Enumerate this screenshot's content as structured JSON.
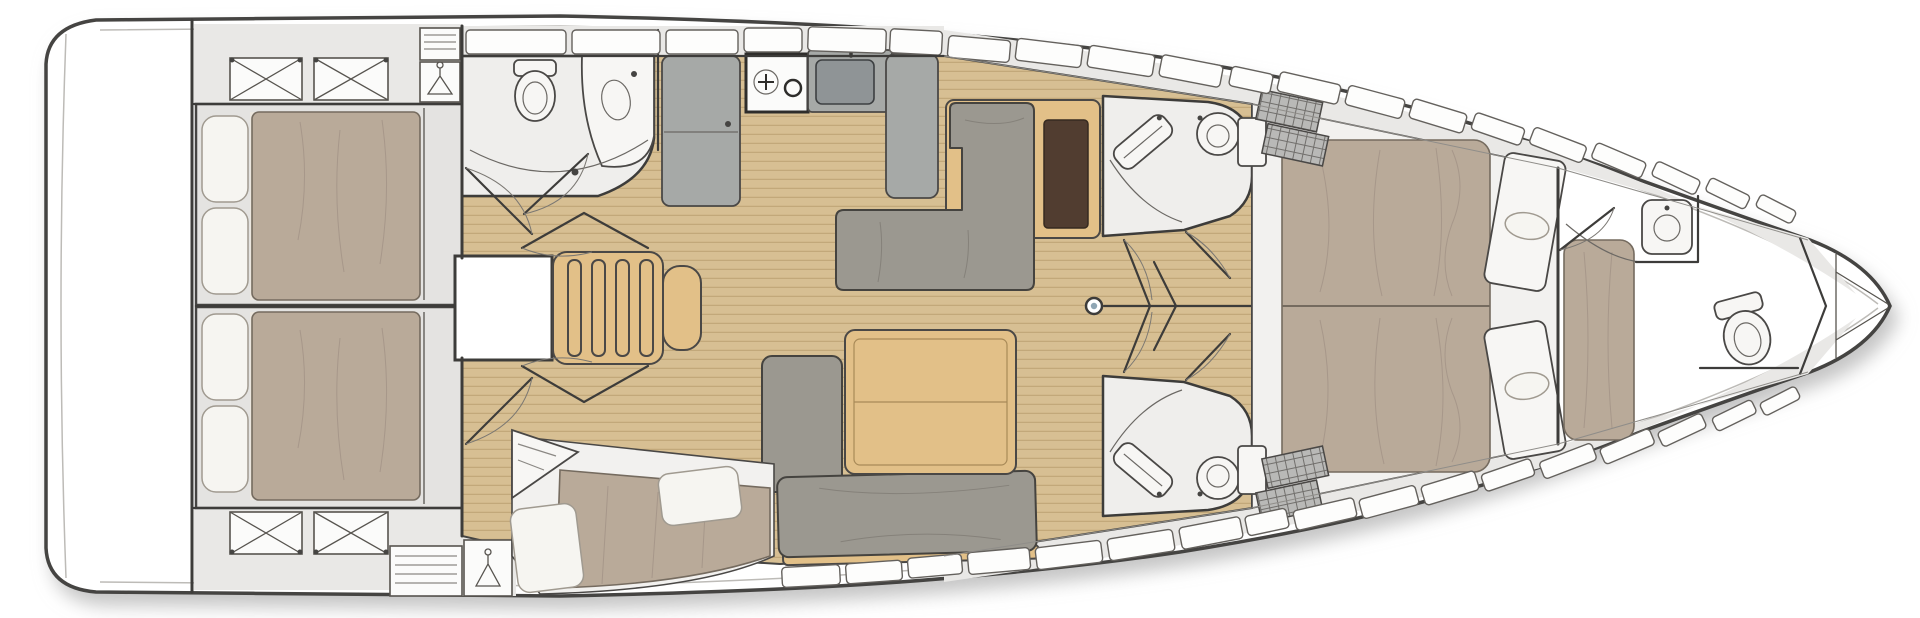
{
  "meta": {
    "title": "Sailing yacht interior layout — overhead deck plan",
    "view": "top-down floor plan",
    "orientation": "bow-right",
    "visible_text": "none"
  },
  "palette": {
    "background": "#ffffff",
    "hull_outline": "#454442",
    "side_deck": "#e9e8e6",
    "wood_floor": "#d7bf93",
    "wood_floor_line": "#c2a87a",
    "furniture_wood": "#e2c088",
    "upholstery_gray": "#9b9890",
    "mattress_taupe": "#b9aa99",
    "pillow_white": "#f6f5f1",
    "fixture_white": "#f7f6f4",
    "appliance_gray": "#a6a9a7",
    "table_dark_brown": "#513d30"
  },
  "icons": {
    "toilet-icon": "toilet bowl (top view)",
    "washbasin-icon": "sink basin with faucet",
    "stove-icon": "two-burner gas stove",
    "sink-icon": "galley sink with faucet",
    "refrigerator-icon": "refrigerator unit",
    "mast-icon": "mast post on centerline",
    "hanger-icon": "hanging locker (clothes hanger)",
    "deck-hatch-x-icon": "deck hatch / skylight (crossed)",
    "grid-hatch-icon": "deck hatch (grated)",
    "steps-icon": "companionway ladder steps",
    "door-swing-icon": "door leaf with swing arc"
  },
  "areas": [
    {
      "id": "hull",
      "label": "Hull with side decks and portlights"
    },
    {
      "id": "swim-platform",
      "label": "Transom / swim platform"
    },
    {
      "id": "aft-cabin-port",
      "label": "Aft double cabin, port side, with berth, pillows, hatches and hanging locker"
    },
    {
      "id": "aft-cabin-starboard",
      "label": "Aft double cabin, starboard side, with berth, pillows, hatches and hanging locker"
    },
    {
      "id": "aft-head",
      "label": "Aft head with toilet, washbasin and shower"
    },
    {
      "id": "galley",
      "label": "Galley with refrigerator, two-burner stove, sink and counters"
    },
    {
      "id": "companionway",
      "label": "Companionway steps over engine compartment"
    },
    {
      "id": "settee-port",
      "label": "Port saloon settee with folding table"
    },
    {
      "id": "dinette-starboard",
      "label": "Starboard saloon dinette with table and sofa"
    },
    {
      "id": "chaise-longue",
      "label": "Starboard chaise longue with cushions"
    },
    {
      "id": "fwd-head-port",
      "label": "Forward head, port side, with toilet and washbasin"
    },
    {
      "id": "fwd-head-starboard",
      "label": "Forward head, starboard side, with toilet and washbasin"
    },
    {
      "id": "corridor",
      "label": "Central corridor with mast post and cabin doors"
    },
    {
      "id": "forward-cabin",
      "label": "Forward owner's cabin with island double berth and bench seats"
    },
    {
      "id": "forward-en-suite",
      "label": "Bow en-suite with washbasin, toilet and upholstered bench"
    },
    {
      "id": "anchor-locker",
      "label": "Bow anchor / sail locker"
    }
  ]
}
